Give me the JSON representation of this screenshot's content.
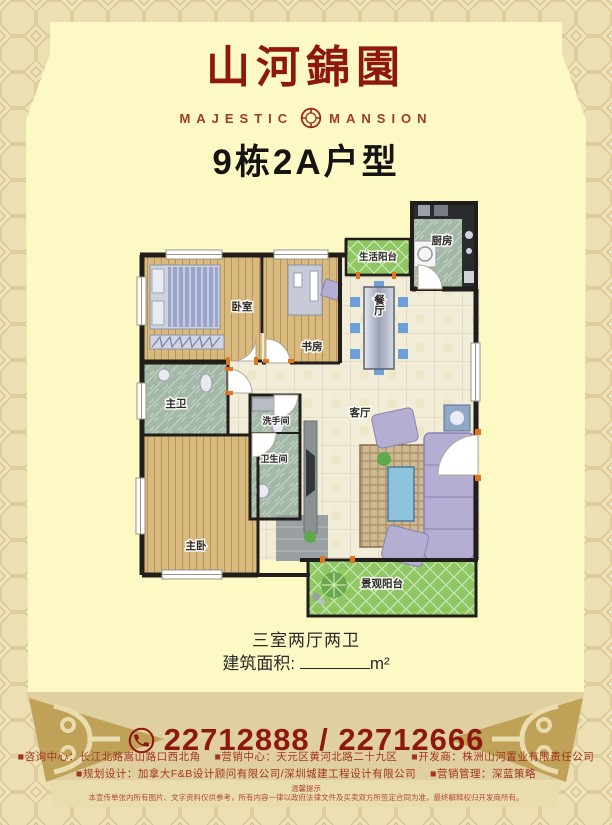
{
  "header": {
    "brand": "山河錦園",
    "english_left": "MAJESTIC",
    "english_right": "MANSION",
    "title": "9栋2A户型"
  },
  "floor_plan": {
    "rooms": {
      "life_balcony": "生活阳台",
      "kitchen": "厨房",
      "bedroom": "卧室",
      "study": "书房",
      "dining": "餐厅",
      "master_bath": "主卫",
      "washroom": "洗手间",
      "bathroom": "卫生间",
      "living": "客厅",
      "master_bedroom": "主卧",
      "view_balcony": "景观阳台"
    }
  },
  "specs": {
    "layout": "三室两厅两卫",
    "area_label": "建筑面积:",
    "area_unit": "m²"
  },
  "phone": {
    "icon": "phone-in-circle",
    "numbers": "22712888 / 22712666"
  },
  "contacts": {
    "line1": [
      "■咨询中心：长江北路嵩山路口西北角",
      "■营销中心：天元区黄河北路二十九区",
      "■开发商：株洲山河置业有限责任公司"
    ],
    "line2": [
      "■规划设计：加拿大F&B设计顾问有限公司/深圳城建工程设计有限公司",
      "■营销管理：深蓝策略"
    ]
  },
  "notice": {
    "title": "温馨提示",
    "body": "本宣传单张内所有图片、文字资料仅供参考，所有内容一律以政府法律文件及买卖双方所签定合同为准，最终解释权归开发商所有。"
  },
  "colors": {
    "brand_red": "#8e180e",
    "contact_red": "#a23420",
    "panel_cream": "#fdf9c5",
    "band_tan": "#e0d0a0",
    "ornament_gold": "#bfa258",
    "balcony_green": "#8fc862",
    "wall_dark": "#201d1b"
  }
}
